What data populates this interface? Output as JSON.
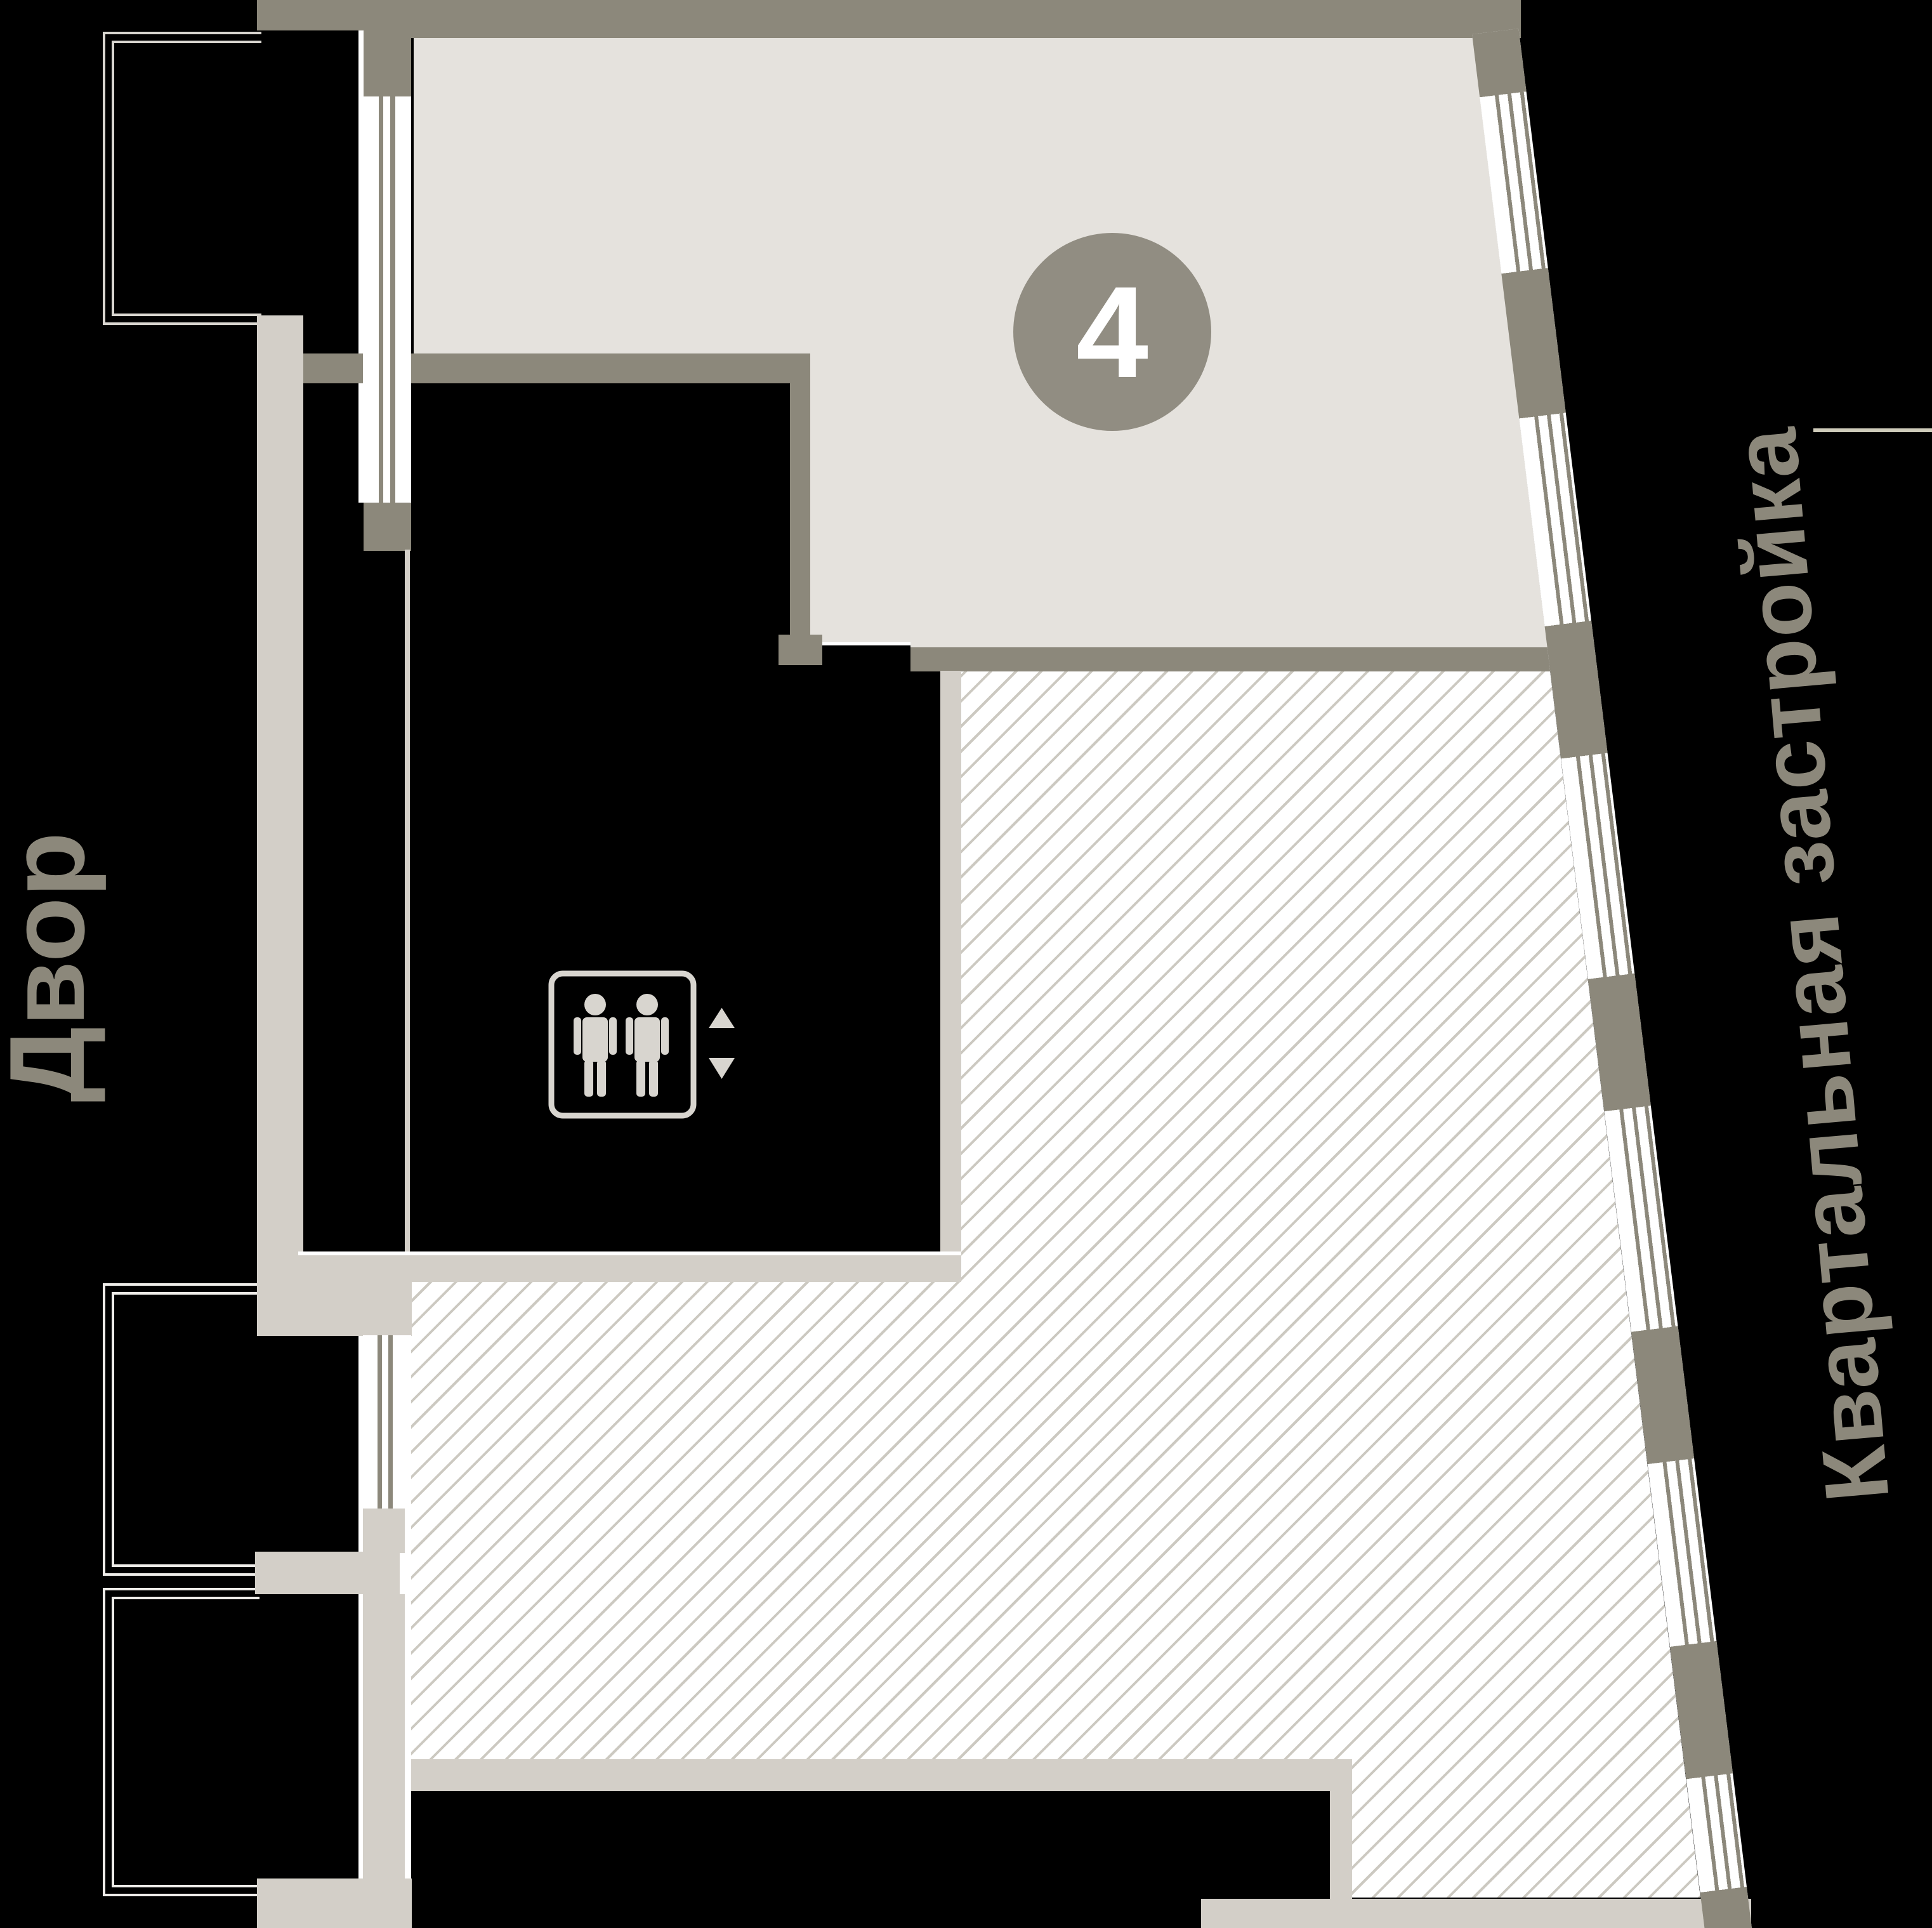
{
  "plan": {
    "badge": {
      "number": "4"
    },
    "labels": {
      "courtyard": "Двор",
      "district": "Квартальная застройка"
    }
  },
  "icons": {
    "elevator": "elevator-people-icon",
    "up": "up-arrow-icon",
    "down": "down-arrow-icon"
  },
  "colors": {
    "wall-dark": "#8c887b",
    "wall-light": "#d3cfc8",
    "floor-beige": "#e5e2dd",
    "hatch-line": "#ccc9c1",
    "outline-room": "#efedea",
    "outline-balcony": "#d9d6d0",
    "badge-bg": "#918d82",
    "badge-text": "#ffffff",
    "label": "#8c887b",
    "icon": "#d8d5cf",
    "accent-line": "#f2eeda"
  }
}
